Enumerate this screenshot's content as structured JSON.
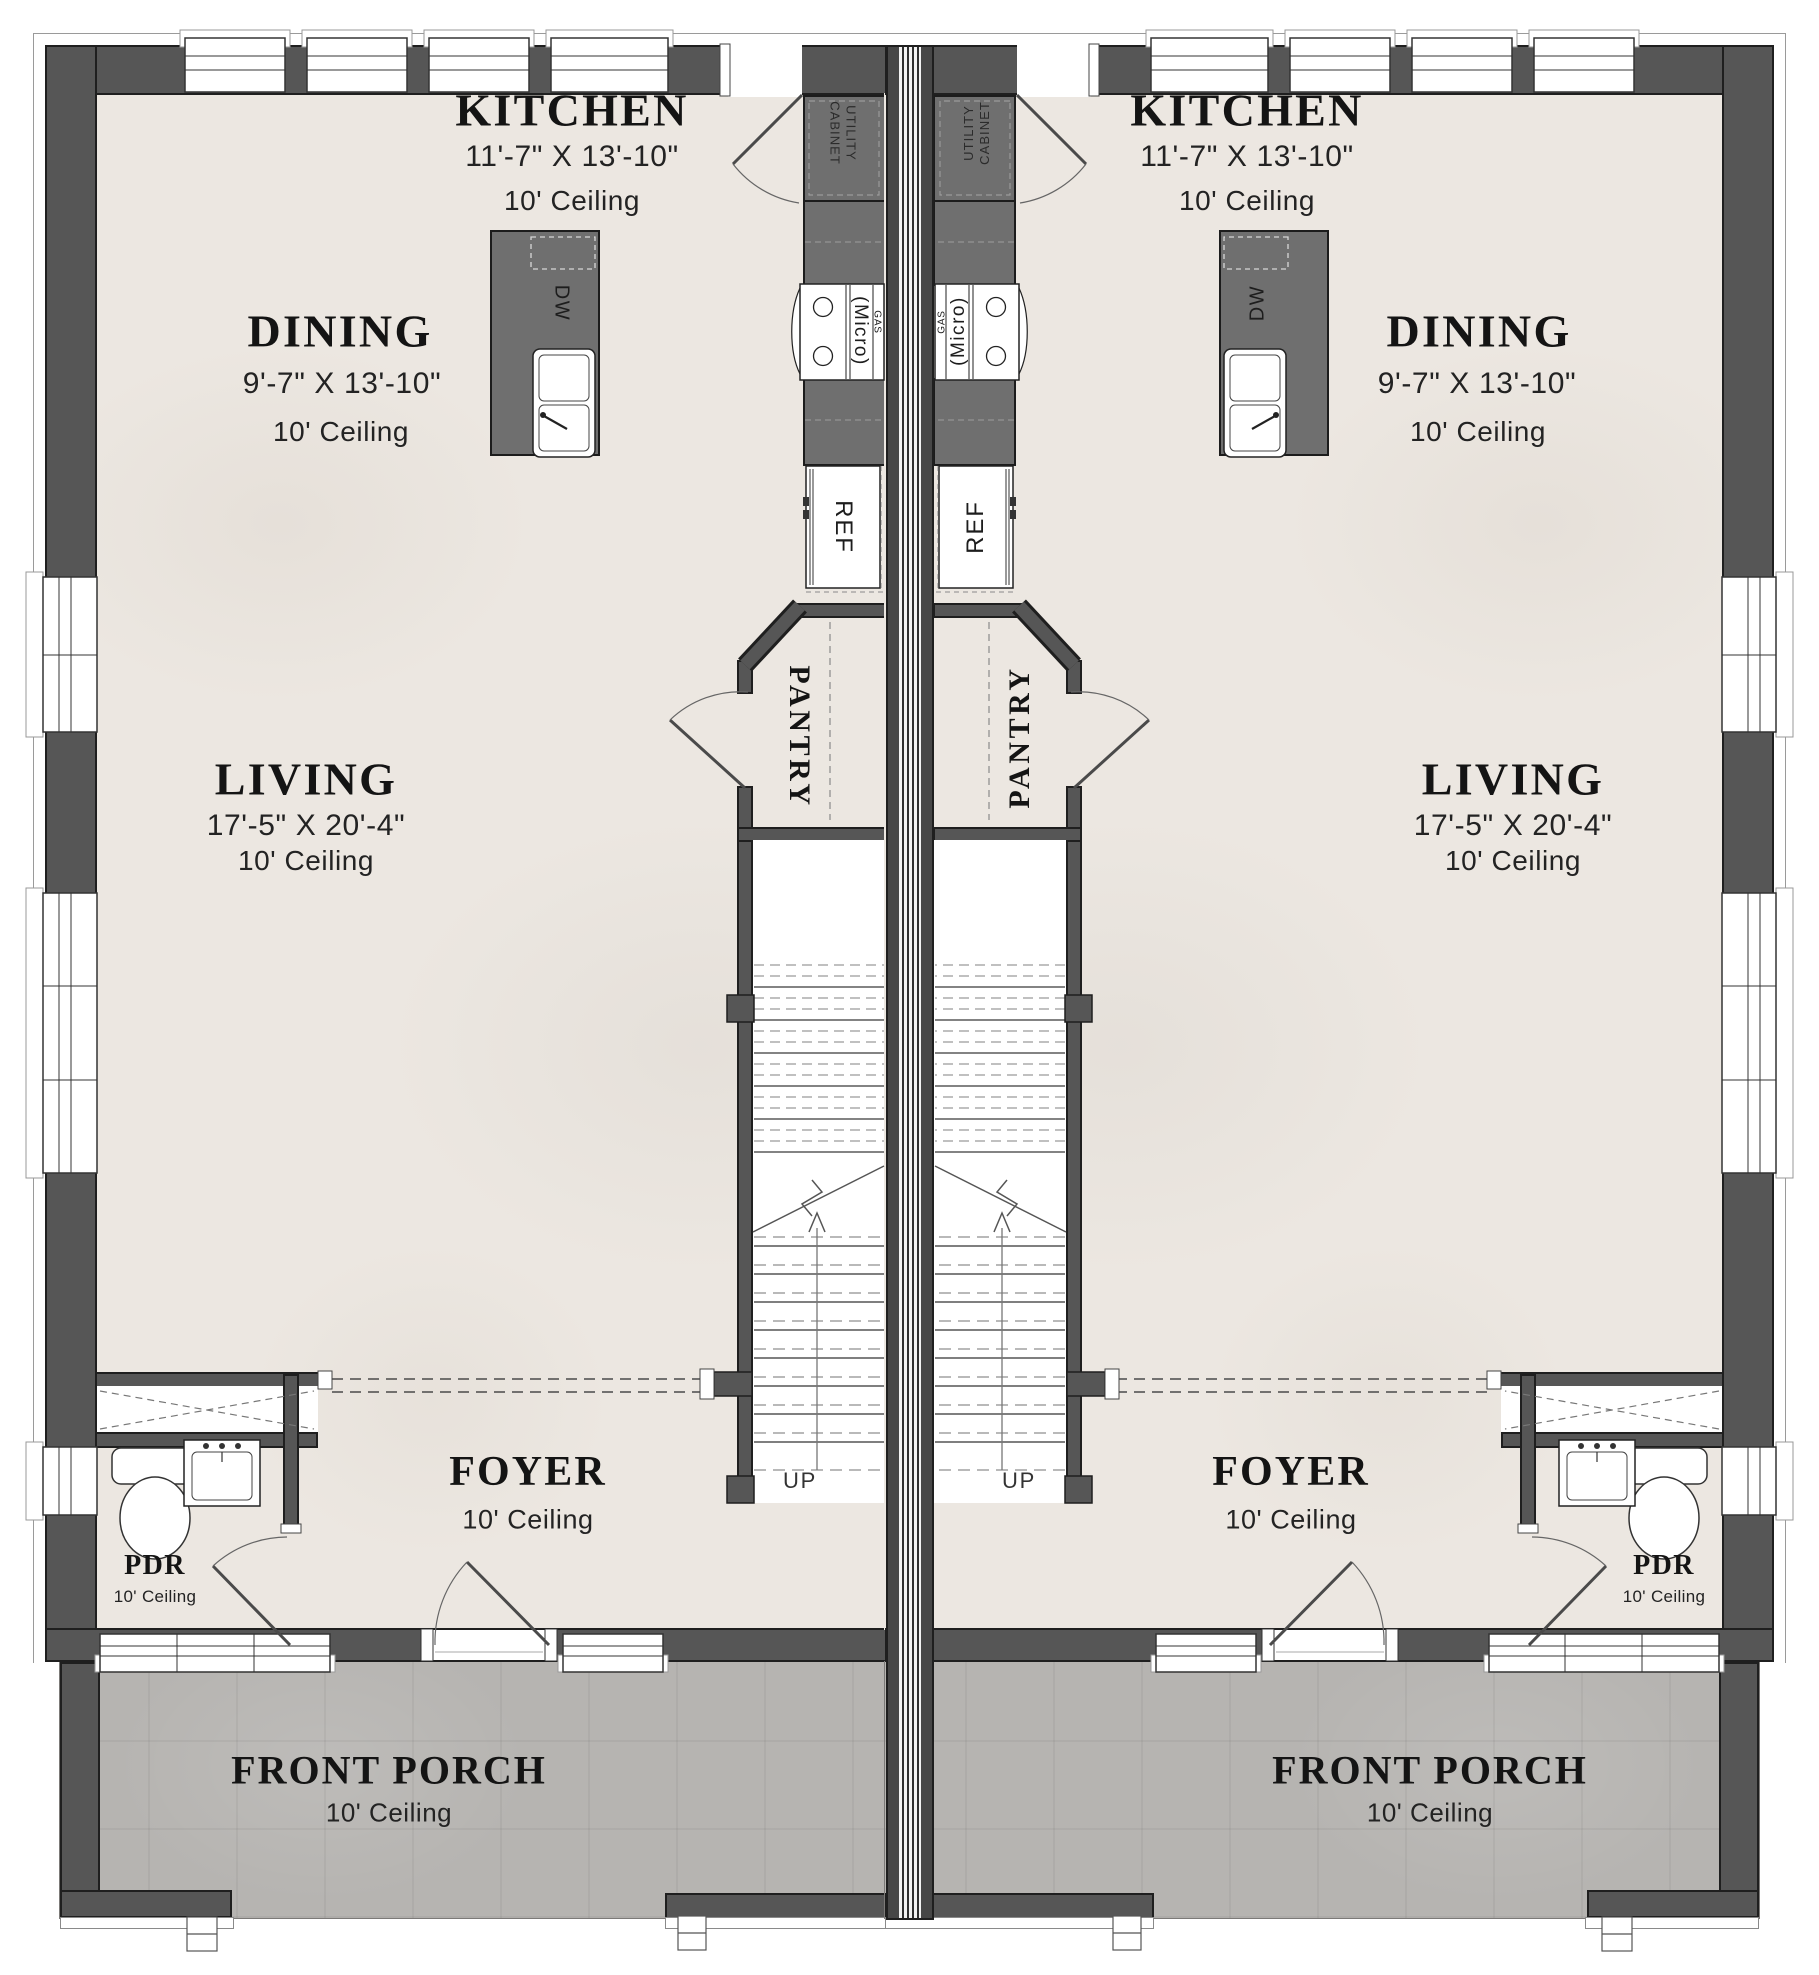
{
  "colors": {
    "wall": "#565656",
    "wall_edge": "#1f1f1f",
    "counter": "#6f6f6f",
    "floor": "#ece7e1",
    "porch": "#b6b4b1",
    "text": "#141414"
  },
  "rooms": {
    "kitchen": {
      "name": "KITCHEN",
      "dims": "11'-7\" X 13'-10\"",
      "ceiling": "10' Ceiling"
    },
    "dining": {
      "name": "DINING",
      "dims": "9'-7\" X 13'-10\"",
      "ceiling": "10' Ceiling"
    },
    "living": {
      "name": "LIVING",
      "dims": "17'-5\" X 20'-4\"",
      "ceiling": "10' Ceiling"
    },
    "foyer": {
      "name": "FOYER",
      "ceiling": "10' Ceiling"
    },
    "pantry": {
      "name": "PANTRY"
    },
    "pdr": {
      "name": "PDR",
      "ceiling": "10' Ceiling"
    },
    "porch": {
      "name": "FRONT PORCH",
      "ceiling": "10' Ceiling"
    }
  },
  "fixtures": {
    "refrigerator": "REF",
    "dishwasher": "DW",
    "microwave": "(Micro)",
    "gas": "GAS",
    "utility_cabinet": "UTILITY CABINET",
    "stairs_up": "UP"
  }
}
